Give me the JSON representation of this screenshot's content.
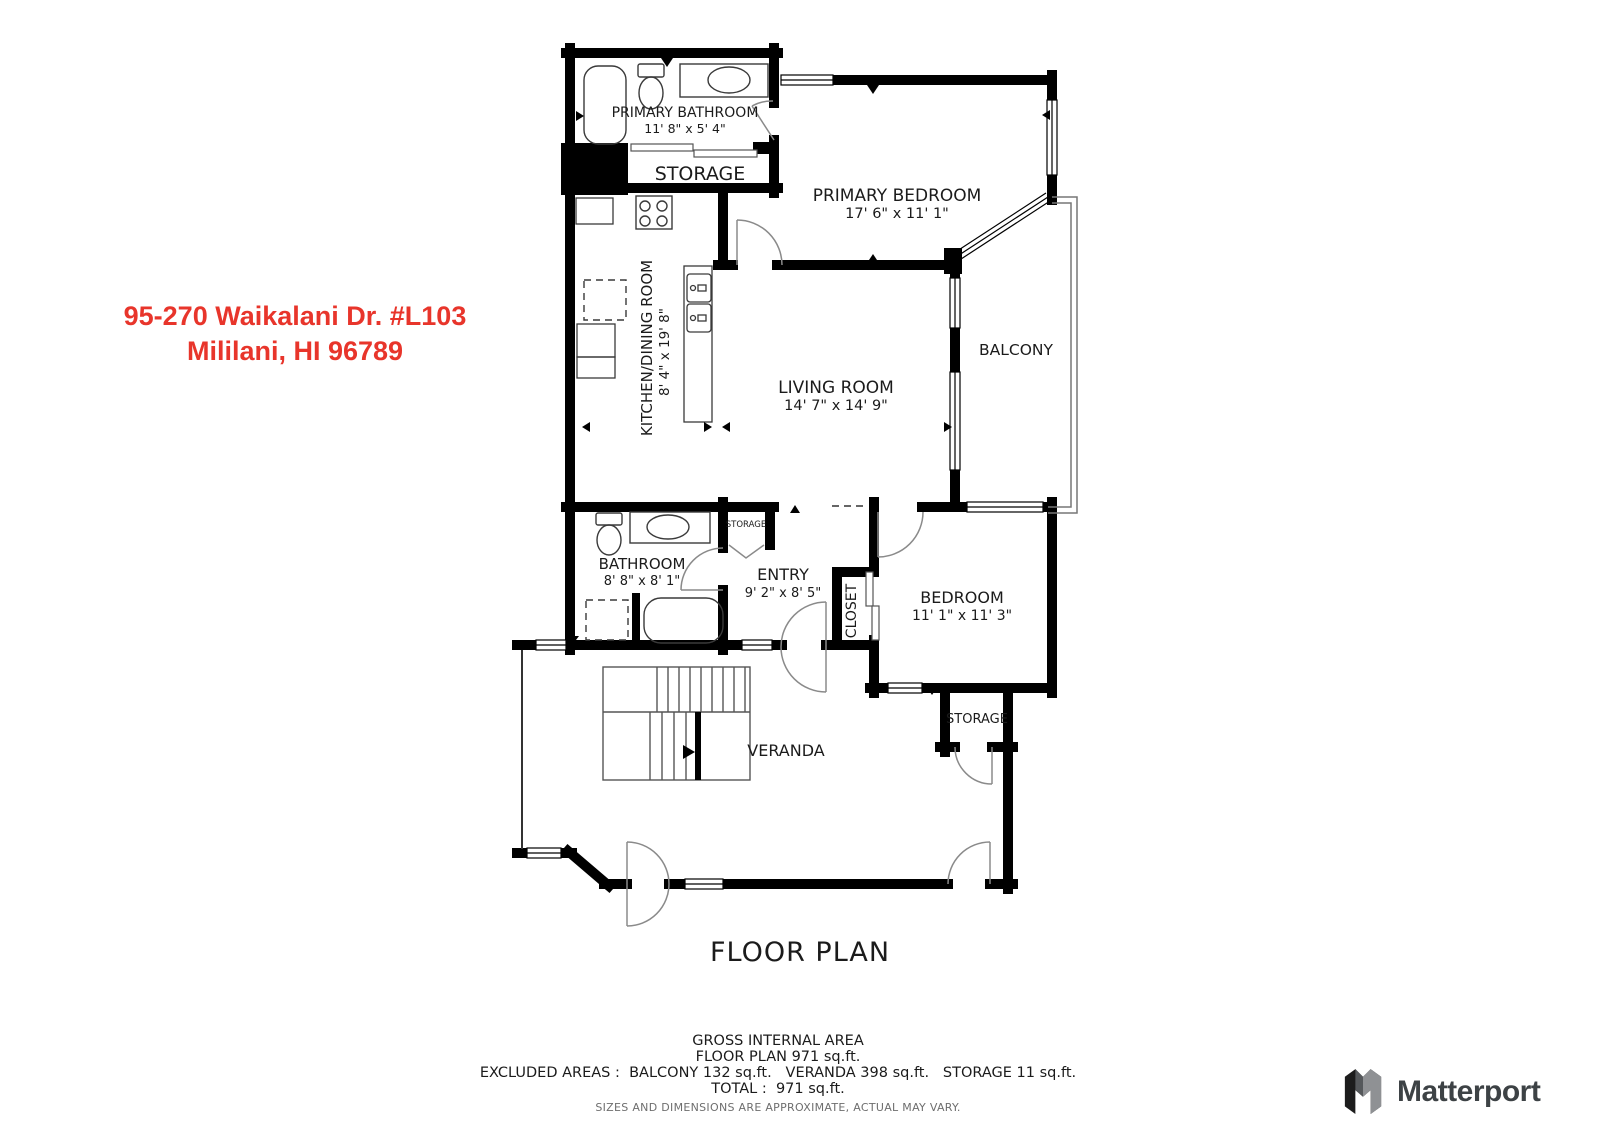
{
  "address": {
    "line1": "95-270 Waikalani Dr. #L103",
    "line2": "Mililani, HI 96789",
    "color": "#e8352b"
  },
  "plan": {
    "title": "FLOOR PLAN",
    "rooms": {
      "primary_bathroom": {
        "name": "PRIMARY BATHROOM",
        "dims": "11' 8\" x 5' 4\""
      },
      "storage_upper": {
        "name": "STORAGE"
      },
      "primary_bedroom": {
        "name": "PRIMARY BEDROOM",
        "dims": "17' 6\" x 11' 1\""
      },
      "kitchen_dining": {
        "name": "KITCHEN/DINING ROOM",
        "dims": "8' 4\" x 19' 8\""
      },
      "living_room": {
        "name": "LIVING ROOM",
        "dims": "14' 7\" x 14' 9\""
      },
      "balcony": {
        "name": "BALCONY"
      },
      "bathroom": {
        "name": "BATHROOM",
        "dims": "8' 8\" x 8' 1\""
      },
      "entry": {
        "name": "ENTRY",
        "dims": "9' 2\" x 8' 5\""
      },
      "closet": {
        "name": "CLOSET"
      },
      "storage_entry": {
        "name": "STORAGE"
      },
      "bedroom": {
        "name": "BEDROOM",
        "dims": "11' 1\" x 11' 3\""
      },
      "storage_bedroom": {
        "name": "STORAGE"
      },
      "veranda": {
        "name": "VERANDA"
      }
    }
  },
  "footer": {
    "line1": "GROSS INTERNAL AREA",
    "line2": "FLOOR PLAN 971 sq.ft.",
    "line3": "EXCLUDED AREAS :  BALCONY 132 sq.ft.   VERANDA 398 sq.ft.   STORAGE 11 sq.ft.",
    "line4": "TOTAL :  971 sq.ft.",
    "line5": "SIZES AND DIMENSIONS ARE APPROXIMATE, ACTUAL MAY VARY."
  },
  "branding": {
    "name": "Matterport"
  }
}
